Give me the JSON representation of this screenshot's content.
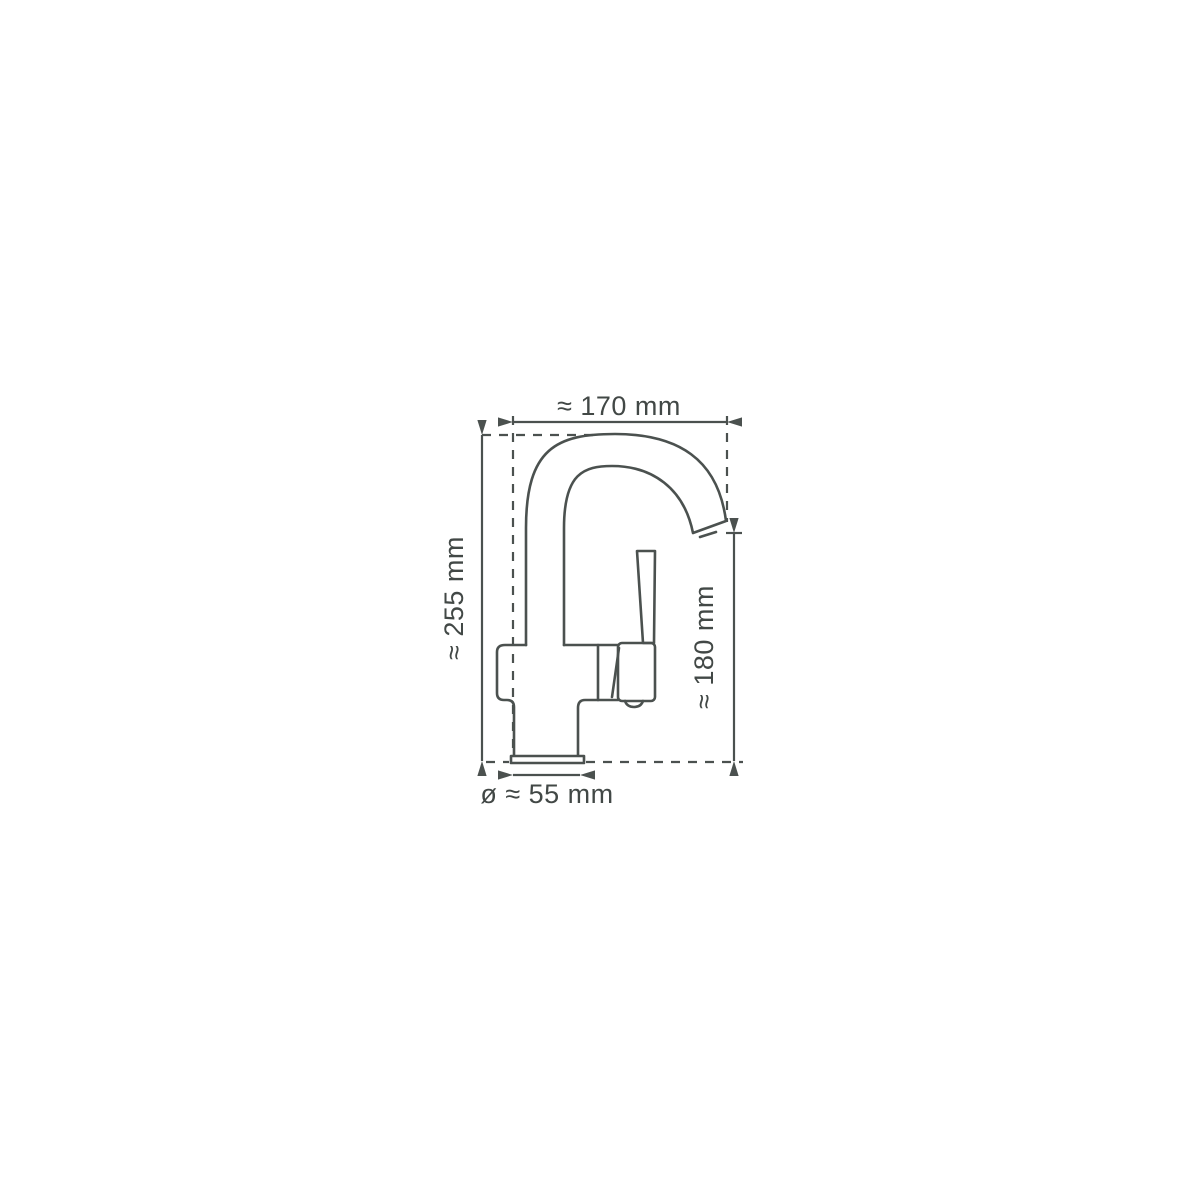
{
  "diagram": {
    "title": "Faucet dimension drawing",
    "subject": "single-lever monobloc basin mixer tap, side profile line drawing with dimension annotations",
    "dimensions": {
      "overall_width_label": "≈ 170 mm",
      "overall_height_label": "≈ 255 mm",
      "spout_height_label": "≈ 180 mm",
      "base_diameter_label": "ø ≈ 55 mm"
    },
    "colors": {
      "line": "#4b514f",
      "text": "#424846",
      "background": "#ffffff"
    }
  }
}
